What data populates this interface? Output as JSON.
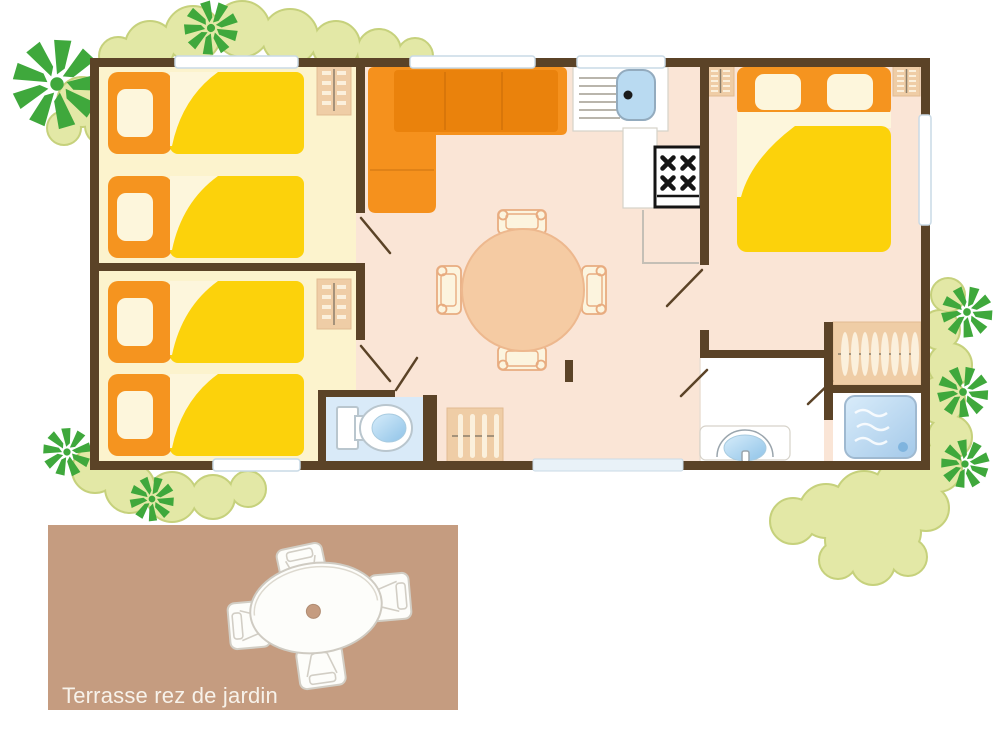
{
  "terrace": {
    "label": "Terrasse rez de jardin"
  },
  "colors": {
    "wall": "#5B4327",
    "bedroom-floor": "#FCF3CD",
    "living-floor": "#FAE5D6",
    "wc-floor": "#D9EAF8",
    "terrace-bg": "#C59C80",
    "terrace-label": "#F7F2EA",
    "sofa-orange": "#F5911D",
    "sofa-orange-dark": "#EA820C",
    "bed-orange": "#F5941F",
    "bed-yellow": "#FCD20B",
    "cream": "#FDF6DC",
    "furniture-tan": "#EFCDA6",
    "table-peach": "#F5CBA3",
    "chair-cream": "#FCF4DE",
    "sink-blue": "#B9DAF1",
    "shower-blue": "#BCD9F0",
    "tree-green": "#3FA83C",
    "foliage-light": "#E3E8A6",
    "foliage-edge": "#C6D17C",
    "stove-black": "#141414",
    "white": "#FFFFFF"
  }
}
